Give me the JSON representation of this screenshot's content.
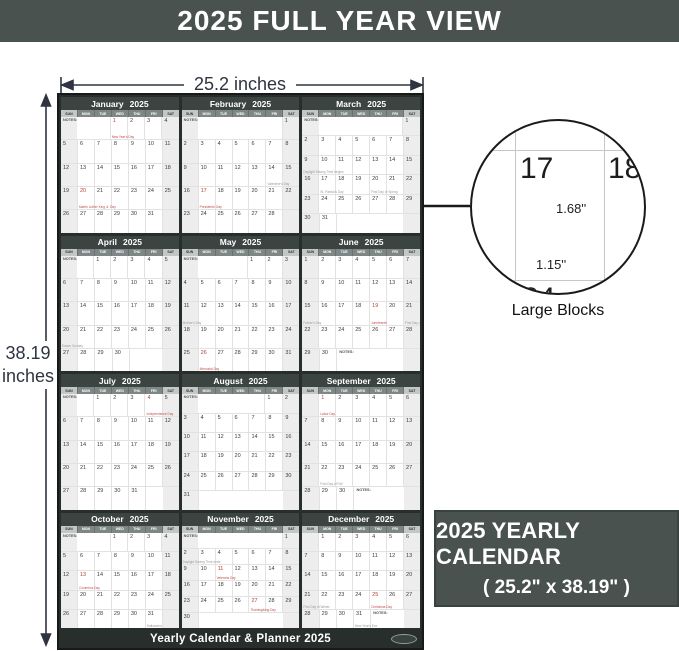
{
  "banner": {
    "title": "2025 FULL YEAR VIEW"
  },
  "dimensions": {
    "width_label": "25.2 inches",
    "height_value": "38.19",
    "height_unit": "inches"
  },
  "callout": {
    "zoom_cells": {
      "top_left": "17",
      "top_right": "18",
      "bottom_left": "24"
    },
    "block_height_label": "1.68''",
    "block_width_label": "1.15''",
    "caption": "Large Blocks"
  },
  "info_box": {
    "line1": "2025 YEARLY CALENDAR",
    "line2": "( 25.2\" x 38.19\" )"
  },
  "poster": {
    "year": "2025",
    "weekday_headers": [
      "SUN",
      "MON",
      "TUE",
      "WED",
      "THU",
      "FRI",
      "SAT"
    ],
    "notes_label": "NOTES:",
    "footer_title": "Yearly Calendar & Planner 2025",
    "months": [
      {
        "name": "January",
        "start_weekday": 3,
        "num_days": 31,
        "notes_position": "start",
        "holidays_red": {
          "1": "New Year's Day",
          "20": "Martin Luther King Jr. Day"
        },
        "notes_gray": {}
      },
      {
        "name": "February",
        "start_weekday": 6,
        "num_days": 28,
        "notes_position": "start",
        "holidays_red": {
          "17": "Presidents' Day"
        },
        "notes_gray": {
          "14": "Valentine's Day"
        }
      },
      {
        "name": "March",
        "start_weekday": 6,
        "num_days": 31,
        "notes_position": "start",
        "holidays_red": {},
        "notes_gray": {
          "9": "Daylight Saving Time begins",
          "17": "St. Patrick's Day",
          "20": "First Day of Spring"
        }
      },
      {
        "name": "April",
        "start_weekday": 2,
        "num_days": 30,
        "notes_position": "start",
        "holidays_red": {},
        "notes_gray": {
          "20": "Easter Sunday"
        }
      },
      {
        "name": "May",
        "start_weekday": 4,
        "num_days": 31,
        "notes_position": "start",
        "holidays_red": {
          "26": "Memorial Day"
        },
        "notes_gray": {
          "11": "Mother's Day"
        }
      },
      {
        "name": "June",
        "start_weekday": 0,
        "num_days": 30,
        "notes_position": "end",
        "holidays_red": {
          "19": "Juneteenth"
        },
        "notes_gray": {
          "15": "Father's Day",
          "21": "First Day of Summer"
        }
      },
      {
        "name": "July",
        "start_weekday": 2,
        "num_days": 31,
        "notes_position": "start",
        "holidays_red": {
          "4": "Independence Day"
        },
        "notes_gray": {}
      },
      {
        "name": "August",
        "start_weekday": 5,
        "num_days": 31,
        "notes_position": "start",
        "holidays_red": {},
        "notes_gray": {}
      },
      {
        "name": "September",
        "start_weekday": 1,
        "num_days": 30,
        "notes_position": "end",
        "holidays_red": {
          "1": "Labor Day"
        },
        "notes_gray": {
          "22": "First Day of Fall"
        }
      },
      {
        "name": "October",
        "start_weekday": 3,
        "num_days": 31,
        "notes_position": "start",
        "holidays_red": {
          "13": "Columbus Day"
        },
        "notes_gray": {
          "31": "Halloween"
        }
      },
      {
        "name": "November",
        "start_weekday": 6,
        "num_days": 30,
        "notes_position": "start",
        "holidays_red": {
          "11": "Veterans Day",
          "27": "Thanksgiving Day"
        },
        "notes_gray": {
          "2": "Daylight Saving Time ends"
        }
      },
      {
        "name": "December",
        "start_weekday": 1,
        "num_days": 31,
        "notes_position": "end",
        "holidays_red": {
          "25": "Christmas Day"
        },
        "notes_gray": {
          "21": "First Day of Winter",
          "31": "New Year's Eve"
        }
      }
    ]
  },
  "colors": {
    "banner_bg": "#4a524f",
    "poster_frame": "#272e2c",
    "month_header_bg": "#3c4442",
    "holiday_red": "#b5403c",
    "weekend_bg": "#ededed",
    "line_dark": "#1a1a1a",
    "dim_text": "#2e3440"
  }
}
